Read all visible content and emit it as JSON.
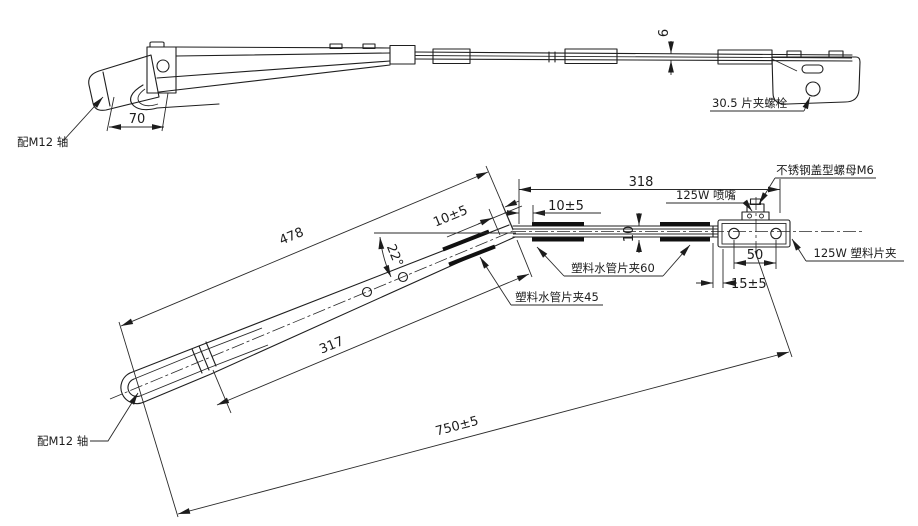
{
  "colors": {
    "background": "#ffffff",
    "line": "#1c1c1c"
  },
  "side_view": {
    "shaft_label": "配M12 轴",
    "dim_head_width": "70",
    "dim_rod_height": "6",
    "bolt_label": "30.5 片夹螺栓"
  },
  "plan_view": {
    "dim_straight_section": "318",
    "nozzle_label": "125W 喷嘴",
    "cap_nut_label": "不锈钢盖型螺母M6",
    "plastic_clip_label": "125W 塑料片夹",
    "dim_upper_arm": "478",
    "bend_angle": "22°",
    "dim_clip_offset_incline": "10±5",
    "dim_clip_offset_straight": "10±5",
    "pipe_clip_60_label": "塑料水管片夹60",
    "dim_rod_width": "10",
    "dim_hole_spacing": "50",
    "dim_end_offset": "15±5",
    "pipe_clip_45_label": "塑料水管片夹45",
    "dim_lower_arm": "317",
    "dim_overall_length": "750±5",
    "shaft_label": "配M12 轴"
  }
}
